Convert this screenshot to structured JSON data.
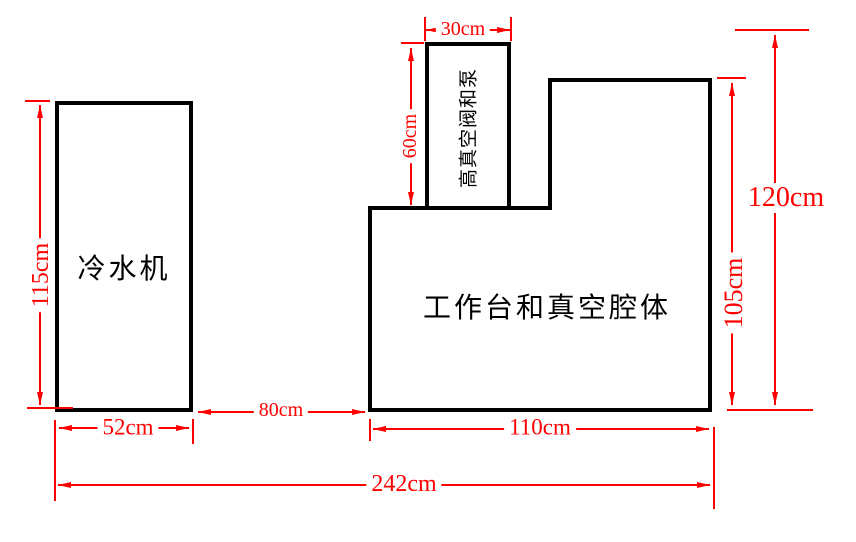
{
  "diagram": {
    "shapes": {
      "chiller": {
        "label": "冷水机"
      },
      "workbench": {
        "label": "工作台和真空腔体"
      },
      "pump": {
        "label": "高真空阀和泵"
      }
    },
    "dimensions": {
      "chiller_height": "115cm",
      "chiller_width": "52cm",
      "gap_width": "80cm",
      "pump_width": "30cm",
      "pump_height": "60cm",
      "workbench_width": "110cm",
      "workbench_height": "105cm",
      "total_height": "120cm",
      "total_width": "242cm"
    },
    "colors": {
      "outline": "#000000",
      "dimension": "#ff0000",
      "background": "#ffffff"
    }
  }
}
